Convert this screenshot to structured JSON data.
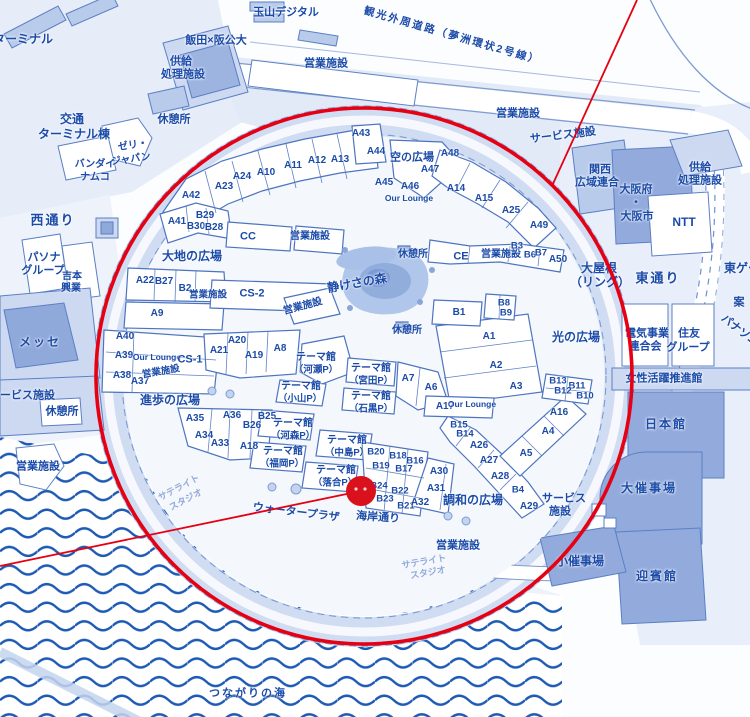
{
  "map": {
    "description": "Expo site map (Yumeshima) with red highlight ring and location marker",
    "colors": {
      "label_text": "#1b4ba8",
      "faint_text": "#92a9d9",
      "outline_blue": "#4d74c0",
      "building_fill": "#b9cbea",
      "building_dark": "#93abdc",
      "land_tint": "#dde7f6",
      "ring_band": "#cfdcf2",
      "water_wave": "#1d5ab4",
      "red": "#e60012",
      "marker_red": "#d8111c"
    },
    "overlay": {
      "color": "#e60012",
      "marker_color": "#d8111c",
      "circle": {
        "cx": 364,
        "cy": 376,
        "r": 268
      },
      "lines": [
        {
          "x1": 637,
          "y1": 0,
          "x2": 552,
          "y2": 186
        },
        {
          "x1": 0,
          "y1": 566,
          "x2": 361,
          "y2": 491
        }
      ],
      "marker": {
        "cx": 361,
        "cy": 491,
        "r": 15
      }
    },
    "labels": [
      {
        "t": "ターミナル",
        "x": 23,
        "y": 39,
        "s": 12
      },
      {
        "t": "玉山デジタル",
        "x": 286,
        "y": 13,
        "s": 11
      },
      {
        "t": "観光外周道路（夢洲環状2号線）",
        "x": 452,
        "y": 36,
        "s": 10.5,
        "r": 16,
        "c": "sp"
      },
      {
        "t": "飯田×阪公大",
        "x": 216,
        "y": 41,
        "s": 11
      },
      {
        "t": "供給",
        "x": 181,
        "y": 62,
        "s": 11
      },
      {
        "t": "処理施設",
        "x": 183,
        "y": 75,
        "s": 11
      },
      {
        "t": "営業施設",
        "x": 326,
        "y": 64,
        "s": 11
      },
      {
        "t": "交通",
        "x": 72,
        "y": 119,
        "s": 12
      },
      {
        "t": "ターミナル棟",
        "x": 74,
        "y": 134,
        "s": 12
      },
      {
        "t": "休憩所",
        "x": 174,
        "y": 120,
        "s": 11
      },
      {
        "t": "ゼリ・",
        "x": 133,
        "y": 146,
        "s": 10,
        "r": -8
      },
      {
        "t": "ジャパン",
        "x": 131,
        "y": 160,
        "s": 10,
        "r": -8
      },
      {
        "t": "バンダイ",
        "x": 95,
        "y": 165,
        "s": 10
      },
      {
        "t": "ナムコ",
        "x": 95,
        "y": 178,
        "s": 10
      },
      {
        "t": "営業施設",
        "x": 518,
        "y": 114,
        "s": 11
      },
      {
        "t": "サービス施設",
        "x": 563,
        "y": 136,
        "s": 11,
        "r": -7
      },
      {
        "t": "関西",
        "x": 600,
        "y": 170,
        "s": 11
      },
      {
        "t": "広域連合",
        "x": 597,
        "y": 183,
        "s": 11
      },
      {
        "t": "大阪府",
        "x": 636,
        "y": 190,
        "s": 11
      },
      {
        "t": "・",
        "x": 636,
        "y": 203,
        "s": 11
      },
      {
        "t": "大阪市",
        "x": 637,
        "y": 217,
        "s": 11
      },
      {
        "t": "供給",
        "x": 700,
        "y": 168,
        "s": 11
      },
      {
        "t": "処理施設",
        "x": 700,
        "y": 181,
        "s": 11
      },
      {
        "t": "NTT",
        "x": 684,
        "y": 222,
        "s": 12
      },
      {
        "t": "西通り",
        "x": 53,
        "y": 220,
        "s": 13,
        "c": "sp"
      },
      {
        "t": "東通り",
        "x": 658,
        "y": 278,
        "s": 13,
        "c": "sp"
      },
      {
        "t": "大屋根",
        "x": 599,
        "y": 268,
        "s": 12
      },
      {
        "t": "（リング）",
        "x": 600,
        "y": 282,
        "s": 12
      },
      {
        "t": "東ゲート",
        "x": 748,
        "y": 268,
        "s": 12
      },
      {
        "t": "案",
        "x": 739,
        "y": 303,
        "s": 11
      },
      {
        "t": "パナソニック",
        "x": 748,
        "y": 338,
        "s": 11,
        "r": 38
      },
      {
        "t": "電気事業",
        "x": 647,
        "y": 334,
        "s": 11
      },
      {
        "t": "連合会",
        "x": 645,
        "y": 347,
        "s": 11
      },
      {
        "t": "住友",
        "x": 689,
        "y": 334,
        "s": 11
      },
      {
        "t": "グループ",
        "x": 688,
        "y": 348,
        "s": 11
      },
      {
        "t": "女性活躍推進館",
        "x": 664,
        "y": 379,
        "s": 11
      },
      {
        "t": "日本館",
        "x": 666,
        "y": 424,
        "s": 12,
        "c": "sp"
      },
      {
        "t": "パソナ",
        "x": 44,
        "y": 258,
        "s": 11
      },
      {
        "t": "グループ",
        "x": 43,
        "y": 271,
        "s": 11
      },
      {
        "t": "吉本",
        "x": 72,
        "y": 277,
        "s": 10
      },
      {
        "t": "興業",
        "x": 71,
        "y": 289,
        "s": 10
      },
      {
        "t": "メッセ",
        "x": 40,
        "y": 342,
        "s": 12,
        "c": "sp"
      },
      {
        "t": "サービス施設",
        "x": 22,
        "y": 396,
        "s": 11
      },
      {
        "t": "休憩所",
        "x": 62,
        "y": 412,
        "s": 11
      },
      {
        "t": "営業施設",
        "x": 38,
        "y": 467,
        "s": 11
      },
      {
        "t": "サテライト",
        "x": 179,
        "y": 488,
        "s": 9,
        "r": -28,
        "c": "faint"
      },
      {
        "t": "スタジオ",
        "x": 186,
        "y": 500,
        "s": 9,
        "r": -28,
        "c": "faint"
      },
      {
        "t": "ウォータープラザ",
        "x": 296,
        "y": 513,
        "s": 11,
        "r": 7
      },
      {
        "t": "海岸通り",
        "x": 378,
        "y": 518,
        "s": 11,
        "r": 4
      },
      {
        "t": "営業施設",
        "x": 458,
        "y": 546,
        "s": 11
      },
      {
        "t": "サテライト",
        "x": 424,
        "y": 562,
        "s": 9,
        "r": -10,
        "c": "faint"
      },
      {
        "t": "スタジオ",
        "x": 428,
        "y": 573,
        "s": 9,
        "r": -10,
        "c": "faint"
      },
      {
        "t": "つながりの海",
        "x": 248,
        "y": 694,
        "s": 11,
        "c": "sp"
      },
      {
        "t": "大催事場",
        "x": 649,
        "y": 488,
        "s": 12,
        "c": "sp"
      },
      {
        "t": "サービス",
        "x": 564,
        "y": 499,
        "s": 11
      },
      {
        "t": "施設",
        "x": 560,
        "y": 512,
        "s": 11
      },
      {
        "t": "小催事場",
        "x": 580,
        "y": 561,
        "s": 12
      },
      {
        "t": "迎賓館",
        "x": 657,
        "y": 576,
        "s": 12,
        "c": "sp"
      },
      {
        "t": "空の広場",
        "x": 412,
        "y": 158,
        "s": 11
      },
      {
        "t": "大地の広場",
        "x": 192,
        "y": 256,
        "s": 12
      },
      {
        "t": "静けさの森",
        "x": 357,
        "y": 283,
        "s": 12,
        "r": -10
      },
      {
        "t": "光の広場",
        "x": 576,
        "y": 337,
        "s": 12
      },
      {
        "t": "進歩の広場",
        "x": 170,
        "y": 400,
        "s": 12
      },
      {
        "t": "調和の広場",
        "x": 473,
        "y": 500,
        "s": 12
      },
      {
        "t": "休憩所",
        "x": 413,
        "y": 255,
        "s": 10
      },
      {
        "t": "休憩所",
        "x": 407,
        "y": 331,
        "s": 10
      },
      {
        "t": "A42",
        "x": 191,
        "y": 196,
        "s": 10
      },
      {
        "t": "A23",
        "x": 224,
        "y": 187,
        "s": 10
      },
      {
        "t": "A24",
        "x": 242,
        "y": 177,
        "s": 10
      },
      {
        "t": "A10",
        "x": 266,
        "y": 173,
        "s": 10
      },
      {
        "t": "A11",
        "x": 293,
        "y": 166,
        "s": 10
      },
      {
        "t": "A12",
        "x": 317,
        "y": 161,
        "s": 10
      },
      {
        "t": "A13",
        "x": 340,
        "y": 160,
        "s": 10
      },
      {
        "t": "A43",
        "x": 361,
        "y": 134,
        "s": 10
      },
      {
        "t": "A44",
        "x": 376,
        "y": 152,
        "s": 10
      },
      {
        "t": "A48",
        "x": 450,
        "y": 154,
        "s": 10
      },
      {
        "t": "A47",
        "x": 430,
        "y": 170,
        "s": 10
      },
      {
        "t": "A45",
        "x": 384,
        "y": 183,
        "s": 10
      },
      {
        "t": "A46",
        "x": 410,
        "y": 187,
        "s": 10
      },
      {
        "t": "Our Lounge",
        "x": 409,
        "y": 198,
        "s": 8.5
      },
      {
        "t": "A14",
        "x": 456,
        "y": 189,
        "s": 10
      },
      {
        "t": "A15",
        "x": 484,
        "y": 199,
        "s": 10
      },
      {
        "t": "A25",
        "x": 511,
        "y": 211,
        "s": 10
      },
      {
        "t": "A49",
        "x": 539,
        "y": 226,
        "s": 10
      },
      {
        "t": "A41",
        "x": 177,
        "y": 222,
        "s": 10
      },
      {
        "t": "B29",
        "x": 205,
        "y": 216,
        "s": 10
      },
      {
        "t": "B30",
        "x": 196,
        "y": 227,
        "s": 10
      },
      {
        "t": "B28",
        "x": 214,
        "y": 228,
        "s": 10
      },
      {
        "t": "CC",
        "x": 248,
        "y": 237,
        "s": 11
      },
      {
        "t": "営業施設",
        "x": 310,
        "y": 237,
        "s": 10
      },
      {
        "t": "CE",
        "x": 461,
        "y": 257,
        "s": 11
      },
      {
        "t": "営業施設",
        "x": 501,
        "y": 255,
        "s": 10
      },
      {
        "t": "B3",
        "x": 517,
        "y": 246,
        "s": 9.5
      },
      {
        "t": "B6",
        "x": 530,
        "y": 255,
        "s": 9.5
      },
      {
        "t": "B7",
        "x": 541,
        "y": 253,
        "s": 9.5
      },
      {
        "t": "A50",
        "x": 558,
        "y": 260,
        "s": 10
      },
      {
        "t": "A22",
        "x": 145,
        "y": 281,
        "s": 10
      },
      {
        "t": "B27",
        "x": 164,
        "y": 282,
        "s": 10
      },
      {
        "t": "B2",
        "x": 185,
        "y": 289,
        "s": 10
      },
      {
        "t": "営業施設",
        "x": 208,
        "y": 295,
        "s": 9.5
      },
      {
        "t": "A9",
        "x": 157,
        "y": 314,
        "s": 10
      },
      {
        "t": "CS-2",
        "x": 252,
        "y": 294,
        "s": 11
      },
      {
        "t": "営業施設",
        "x": 303,
        "y": 307,
        "s": 10,
        "r": -15
      },
      {
        "t": "B1",
        "x": 459,
        "y": 313,
        "s": 10
      },
      {
        "t": "B8",
        "x": 504,
        "y": 303,
        "s": 9.5
      },
      {
        "t": "B9",
        "x": 506,
        "y": 313,
        "s": 9.5
      },
      {
        "t": "A1",
        "x": 489,
        "y": 337,
        "s": 10
      },
      {
        "t": "A2",
        "x": 496,
        "y": 366,
        "s": 10
      },
      {
        "t": "A3",
        "x": 516,
        "y": 387,
        "s": 10
      },
      {
        "t": "A40",
        "x": 125,
        "y": 337,
        "s": 10
      },
      {
        "t": "A39",
        "x": 124,
        "y": 356,
        "s": 10
      },
      {
        "t": "Our Lounge",
        "x": 157,
        "y": 357,
        "s": 8.5
      },
      {
        "t": "CS-1",
        "x": 190,
        "y": 360,
        "s": 11
      },
      {
        "t": "A38",
        "x": 122,
        "y": 376,
        "s": 10
      },
      {
        "t": "A37",
        "x": 140,
        "y": 382,
        "s": 10
      },
      {
        "t": "営業施設",
        "x": 161,
        "y": 372,
        "s": 9.5,
        "r": -10
      },
      {
        "t": "A21",
        "x": 219,
        "y": 351,
        "s": 10
      },
      {
        "t": "A20",
        "x": 237,
        "y": 341,
        "s": 10
      },
      {
        "t": "A19",
        "x": 254,
        "y": 356,
        "s": 10
      },
      {
        "t": "A8",
        "x": 280,
        "y": 349,
        "s": 10
      },
      {
        "t": "テーマ館",
        "x": 316,
        "y": 358,
        "s": 10
      },
      {
        "t": "（河瀬P）",
        "x": 316,
        "y": 370,
        "s": 9.5
      },
      {
        "t": "テーマ館",
        "x": 301,
        "y": 387,
        "s": 10
      },
      {
        "t": "（小山P）",
        "x": 300,
        "y": 399,
        "s": 9.5
      },
      {
        "t": "テーマ館",
        "x": 371,
        "y": 369,
        "s": 10
      },
      {
        "t": "（宮田P）",
        "x": 371,
        "y": 381,
        "s": 9.5
      },
      {
        "t": "テーマ館",
        "x": 371,
        "y": 397,
        "s": 10
      },
      {
        "t": "（石黒P）",
        "x": 371,
        "y": 409,
        "s": 9.5
      },
      {
        "t": "A7",
        "x": 408,
        "y": 379,
        "s": 10
      },
      {
        "t": "A6",
        "x": 431,
        "y": 388,
        "s": 10
      },
      {
        "t": "A17",
        "x": 445,
        "y": 407,
        "s": 10
      },
      {
        "t": "Our Lounge",
        "x": 472,
        "y": 404,
        "s": 8.5
      },
      {
        "t": "A35",
        "x": 195,
        "y": 419,
        "s": 10
      },
      {
        "t": "A36",
        "x": 232,
        "y": 416,
        "s": 10
      },
      {
        "t": "B25",
        "x": 267,
        "y": 417,
        "s": 10
      },
      {
        "t": "B26",
        "x": 252,
        "y": 426,
        "s": 10
      },
      {
        "t": "A34",
        "x": 204,
        "y": 436,
        "s": 10
      },
      {
        "t": "A33",
        "x": 220,
        "y": 444,
        "s": 10
      },
      {
        "t": "A18",
        "x": 249,
        "y": 447,
        "s": 10
      },
      {
        "t": "テーマ館",
        "x": 293,
        "y": 424,
        "s": 10
      },
      {
        "t": "（河森P）",
        "x": 293,
        "y": 436,
        "s": 9.5
      },
      {
        "t": "テーマ館",
        "x": 283,
        "y": 452,
        "s": 10
      },
      {
        "t": "（福岡P）",
        "x": 282,
        "y": 464,
        "s": 9.5
      },
      {
        "t": "テーマ館",
        "x": 347,
        "y": 441,
        "s": 10
      },
      {
        "t": "（中島P）",
        "x": 347,
        "y": 453,
        "s": 9.5
      },
      {
        "t": "テーマ館",
        "x": 336,
        "y": 471,
        "s": 10
      },
      {
        "t": "（落合P）",
        "x": 335,
        "y": 483,
        "s": 9.5
      },
      {
        "t": "B20",
        "x": 376,
        "y": 452,
        "s": 9.5
      },
      {
        "t": "B18",
        "x": 398,
        "y": 456,
        "s": 9.5
      },
      {
        "t": "B16",
        "x": 415,
        "y": 461,
        "s": 9.5
      },
      {
        "t": "B19",
        "x": 381,
        "y": 466,
        "s": 9.5
      },
      {
        "t": "B17",
        "x": 404,
        "y": 469,
        "s": 9.5
      },
      {
        "t": "B24",
        "x": 379,
        "y": 486,
        "s": 9.5
      },
      {
        "t": "B22",
        "x": 400,
        "y": 491,
        "s": 9.5
      },
      {
        "t": "B23",
        "x": 385,
        "y": 499,
        "s": 9.5
      },
      {
        "t": "B21",
        "x": 406,
        "y": 506,
        "s": 9.5
      },
      {
        "t": "A30",
        "x": 439,
        "y": 472,
        "s": 10
      },
      {
        "t": "A31",
        "x": 436,
        "y": 489,
        "s": 10
      },
      {
        "t": "A32",
        "x": 420,
        "y": 503,
        "s": 10
      },
      {
        "t": "B15",
        "x": 459,
        "y": 425,
        "s": 9.5
      },
      {
        "t": "B14",
        "x": 465,
        "y": 434,
        "s": 9.5
      },
      {
        "t": "A26",
        "x": 479,
        "y": 446,
        "s": 10
      },
      {
        "t": "A27",
        "x": 489,
        "y": 461,
        "s": 10
      },
      {
        "t": "A28",
        "x": 500,
        "y": 477,
        "s": 10
      },
      {
        "t": "B4",
        "x": 518,
        "y": 490,
        "s": 9.5
      },
      {
        "t": "A29",
        "x": 529,
        "y": 507,
        "s": 10
      },
      {
        "t": "A16",
        "x": 559,
        "y": 413,
        "s": 10
      },
      {
        "t": "A4",
        "x": 548,
        "y": 432,
        "s": 10
      },
      {
        "t": "A5",
        "x": 526,
        "y": 454,
        "s": 10
      },
      {
        "t": "B13",
        "x": 558,
        "y": 381,
        "s": 9.5
      },
      {
        "t": "B11",
        "x": 577,
        "y": 386,
        "s": 9.5
      },
      {
        "t": "B12",
        "x": 563,
        "y": 391,
        "s": 9.5
      },
      {
        "t": "B10",
        "x": 585,
        "y": 396,
        "s": 9.5
      }
    ]
  }
}
